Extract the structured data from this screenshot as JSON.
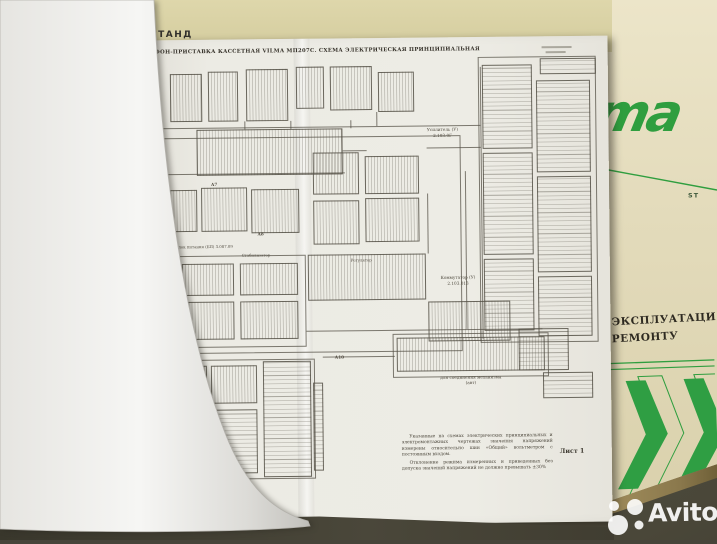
{
  "photo": {
    "watermark_brand": "Avito"
  },
  "top_page": {
    "heading_fragment": "СТАНД"
  },
  "cover": {
    "logo_fragment": "ma",
    "subtitle_fragment": "ST",
    "text_line1": "О ЭКСПЛУАТАЦИ",
    "text_line2": "О РЕМОНТУ",
    "accent_green": "#2f9e3f"
  },
  "schematic": {
    "title": "ТОФОН-ПРИСТАВКА КАССЕТНАЯ VILMA МП207С. СХЕМА ЭЛЕКТРИЧЕСКАЯ ПРИНЦИПИАЛЬНАЯ",
    "sheet_label": "Лист 1",
    "notes": {
      "para1": "Указанные на схемах электрических принципиальных и электромонтажных чертежах значения напряжений измерены относительно шин «Общий» вольтметром с постоянным входом.",
      "para2": "Отклонение режима измеренных и приведенных без допуска значений напряжений не должно превышать ±30%"
    },
    "labels": {
      "amplifier_line1": "Усилитель (У)",
      "amplifier_line2": "2.103.0Г",
      "commutator_line1": "Коммутатор (У)",
      "commutator_line2": "2.103.013",
      "power_unit": "Блок питания (БП) 3.087.09",
      "stabilizer": "Стабилизатор",
      "regulator": "Регулятор",
      "connector_caption_line1": "для соединения механизма",
      "connector_caption_line2": "(авт)",
      "designator_a7": "А7",
      "designator_a8": "А8",
      "designator_a10": "А10"
    }
  }
}
